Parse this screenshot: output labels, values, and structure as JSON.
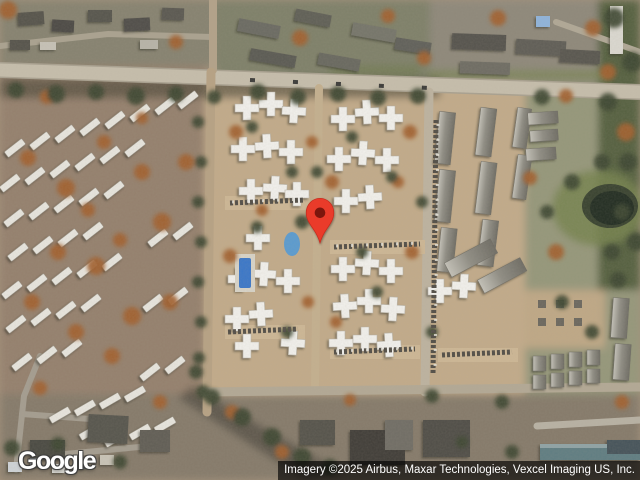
{
  "map": {
    "type": "satellite-imagery",
    "branding": {
      "logo_text": "Google"
    },
    "attribution": {
      "text": "Imagery ©2025 Airbus, Maxar Technologies, Vexcel Imaging US, Inc."
    },
    "marker": {
      "name": "location-pin",
      "pin_color": "#EA3B2B",
      "pin_inner_color": "#7C170C",
      "tip_x": 320,
      "tip_y": 243
    },
    "palette": {
      "terrain_tan": "#c2ab8a",
      "terrain_brown": "#94806d",
      "road_gray": "#c6beac",
      "tree_green": "#3c4730",
      "tree_rust": "#a2612f",
      "building_white": "#f2f1ed",
      "roof_gray": "#62625a",
      "pond_water": "#222d22",
      "pool_blue": "#3a77c9",
      "attribution_bg": "rgba(0,0,0,0.65)",
      "text_white": "#ffffff"
    }
  }
}
